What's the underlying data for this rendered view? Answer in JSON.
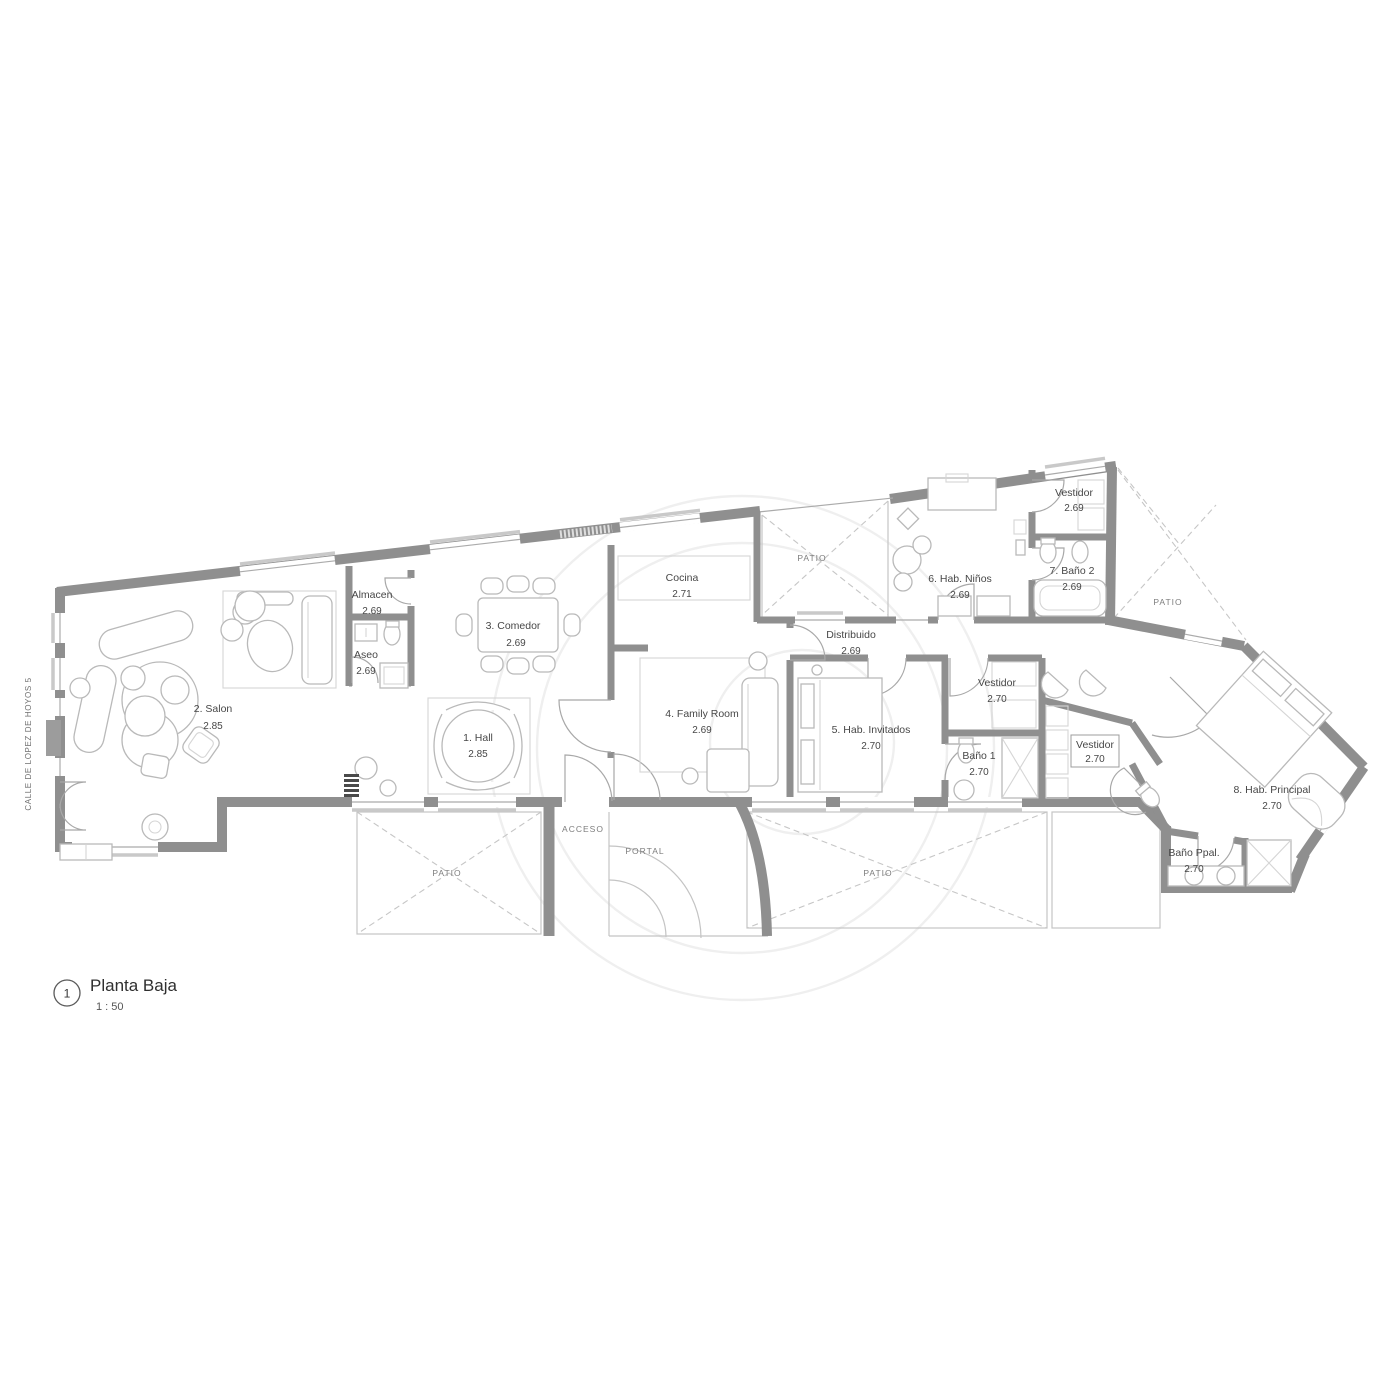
{
  "titleblock": {
    "number": "1",
    "title": "Planta Baja",
    "scale": "1 : 50"
  },
  "street": {
    "label": "CALLE DE LOPEZ DE HOYOS 5"
  },
  "rooms": [
    {
      "id": "hall",
      "name": "1. Hall",
      "height": "2.85"
    },
    {
      "id": "salon",
      "name": "2. Salon",
      "height": "2.85"
    },
    {
      "id": "comedor",
      "name": "3. Comedor",
      "height": "2.69"
    },
    {
      "id": "family-room",
      "name": "4. Family Room",
      "height": "2.69"
    },
    {
      "id": "hab-invitados",
      "name": "5. Hab. Invitados",
      "height": "2.70"
    },
    {
      "id": "hab-ninos",
      "name": "6. Hab. Niños",
      "height": "2.69"
    },
    {
      "id": "bano-2",
      "name": "7. Baño 2",
      "height": "2.69"
    },
    {
      "id": "hab-principal",
      "name": "8. Hab. Principal",
      "height": "2.70"
    },
    {
      "id": "almacen",
      "name": "Almacen",
      "height": "2.69"
    },
    {
      "id": "aseo",
      "name": "Aseo",
      "height": "2.69"
    },
    {
      "id": "cocina",
      "name": "Cocina",
      "height": "2.71"
    },
    {
      "id": "distribuidor",
      "name": "Distribuido",
      "height": "2.69"
    },
    {
      "id": "vestidor-ninos",
      "name": "Vestidor",
      "height": "2.69"
    },
    {
      "id": "vestidor-invitados",
      "name": "Vestidor",
      "height": "2.70"
    },
    {
      "id": "vestidor-principal",
      "name": "Vestidor",
      "height": "2.70"
    },
    {
      "id": "bano-1",
      "name": "Baño 1",
      "height": "2.70"
    },
    {
      "id": "bano-ppal",
      "name": "Baño Ppal.",
      "height": "2.70"
    }
  ],
  "areas": {
    "patio": "PATIO",
    "acceso": "ACCESO",
    "portal": "PORTAL"
  },
  "colors": {
    "wall": "#8f8f8f",
    "furniture": "#b9b9b9",
    "text": "#474747",
    "dashed": "#c6c6c6"
  }
}
